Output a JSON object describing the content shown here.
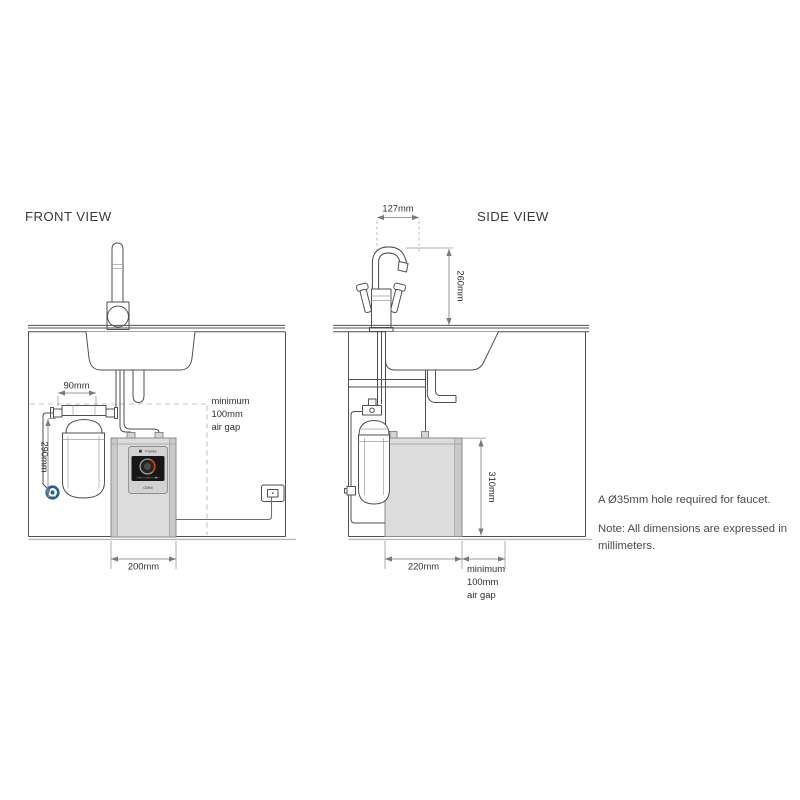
{
  "front_view": {
    "title": "FRONT VIEW",
    "dim_filter_width": "90mm",
    "dim_filter_height": "290mm",
    "dim_unit_width": "200mm",
    "air_gap": {
      "line1": "minimum",
      "line2": "100mm",
      "line3": "air gap"
    }
  },
  "side_view": {
    "title": "SIDE VIEW",
    "dim_spout_reach": "127mm",
    "dim_spout_height": "260mm",
    "dim_tank_height": "310mm",
    "dim_tank_depth": "220mm",
    "air_gap": {
      "line1": "minimum",
      "line2": "100mm",
      "line3": "air gap"
    }
  },
  "unit_panel": {
    "brand": "Franke",
    "model": "OMNI"
  },
  "notes": {
    "hole_requirement": "A Ø35mm hole required for faucet.",
    "dimensions_note_line1": "Note: All dimensions are expressed in",
    "dimensions_note_line2": "millimeters."
  },
  "colors": {
    "line": "#4f4f4f",
    "dimension": "#7a7a7a",
    "dashed_clearance": "#c4c4c4",
    "unit_fill": "#dcdcdc",
    "unit_band": "#c9c9c9",
    "panel_screen": "#161616",
    "dial_red": "#cf3a1f",
    "connection_marker_blue": "#1e5fa8",
    "background": "#ffffff"
  }
}
